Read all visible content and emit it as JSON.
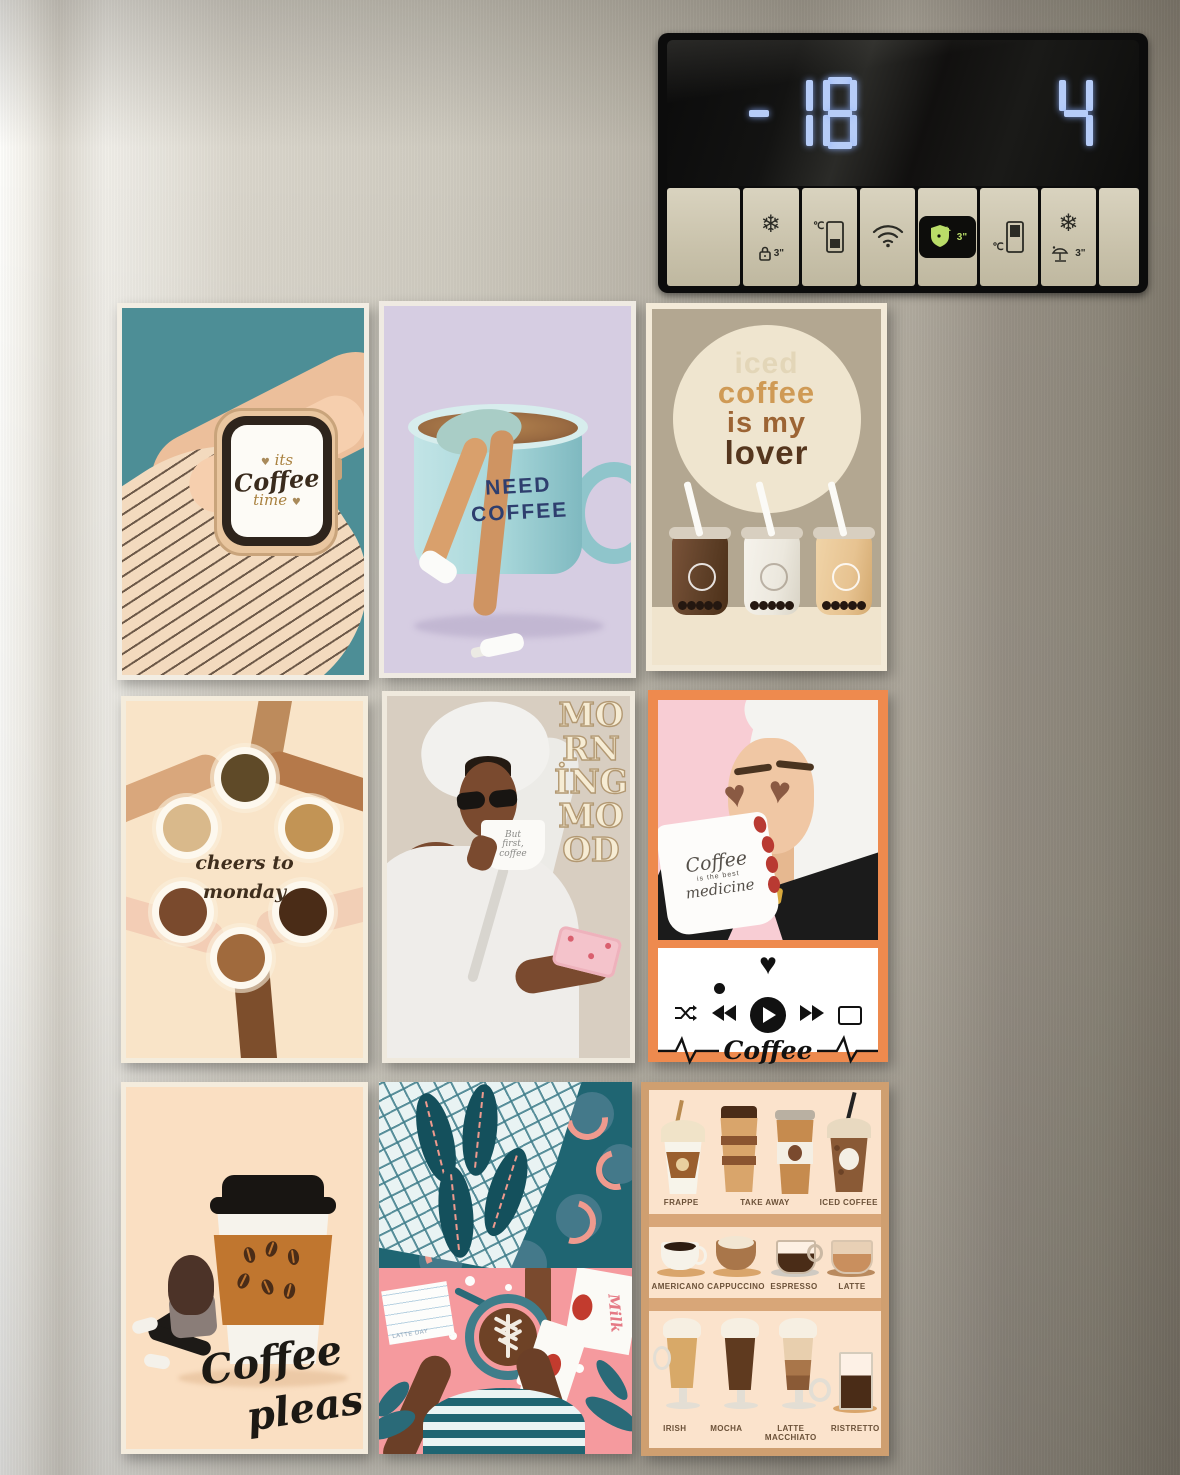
{
  "display": {
    "freezer_temp": "-18",
    "fridge_temp": "4",
    "digit_color": "#b6ccf8"
  },
  "panel": {
    "hold_label": "3\"",
    "button_beige": "#cdc6b0",
    "active_green": "#b9dc68",
    "buttons": [
      {
        "name": "blank-left"
      },
      {
        "name": "freezer-power-lock"
      },
      {
        "name": "freezer-temp"
      },
      {
        "name": "wifi"
      },
      {
        "name": "hygiene-fresh",
        "active": true
      },
      {
        "name": "fridge-temp"
      },
      {
        "name": "vacation"
      },
      {
        "name": "blank-right"
      }
    ]
  },
  "cards": {
    "watch": {
      "bg": "#4d8e96",
      "line1": "its",
      "line2": "Coffee",
      "line3": "time",
      "heart": "♥"
    },
    "need_coffee": {
      "bg": "#d6cde2",
      "line1": "NEED",
      "line2": "COFFEE"
    },
    "iced_lover": {
      "bg": "#b3a791",
      "w1": "iced",
      "w2": "coffee",
      "w3": "is my",
      "w4": "lover"
    },
    "cheers": {
      "bg": "#f9e4c8",
      "line1": "cheers to",
      "line2": "monday"
    },
    "morning_mood": {
      "bg": "#d8cec1",
      "vertical": [
        "MO",
        "RN",
        "İNG",
        "MO",
        "OD"
      ],
      "mug1": "But",
      "mug2": "first,",
      "mug3": "coffee"
    },
    "coffee_medicine": {
      "frame": "#ee8a4e",
      "mug1": "Coffee",
      "mug2": "is the best",
      "mug3": "medicine",
      "heart": "♥",
      "song_title": "Coffee"
    },
    "coffee_please": {
      "bg": "#fadfc2",
      "line1": "Coffee",
      "line2": "please"
    },
    "latte_day": {
      "milk_label": "Milk",
      "note_label": "LATTE DAY"
    },
    "coffee_types": {
      "row1": [
        "FRAPPE",
        "TAKE AWAY",
        "ICED COFFEE"
      ],
      "row2": [
        "AMERICANO",
        "CAPPUCCINO",
        "ESPRESSO",
        "LATTE"
      ],
      "row3": [
        "IRISH",
        "MOCHA",
        "LATTE MACCHIATO",
        "RISTRETTO"
      ]
    }
  }
}
